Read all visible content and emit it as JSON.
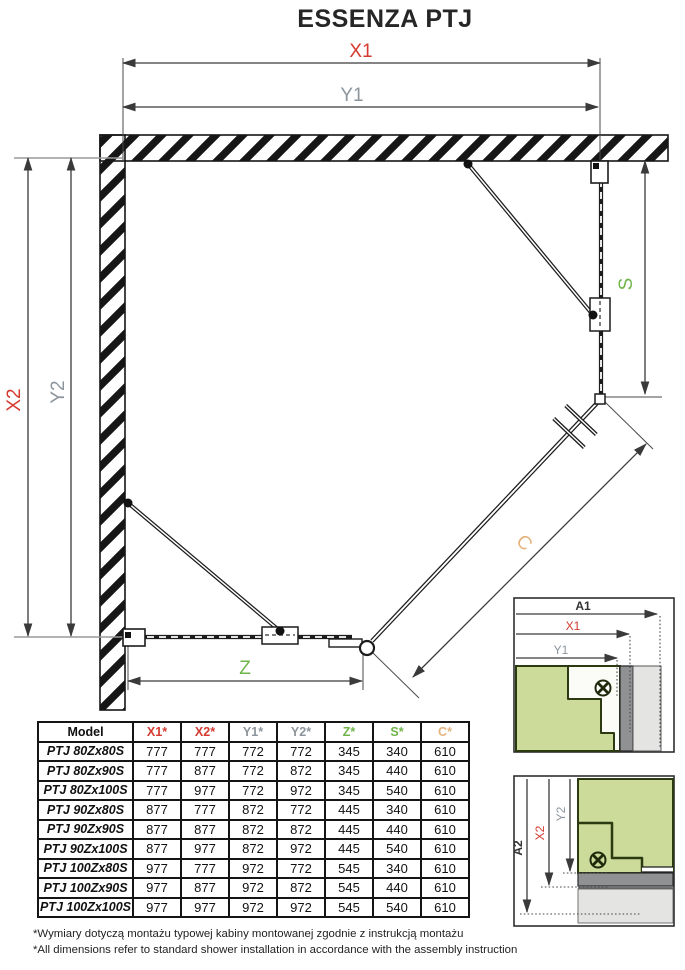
{
  "title": "ESSENZA PTJ",
  "colors": {
    "red": "#d43a2f",
    "gray": "#8d959c",
    "green": "#6fb44a",
    "tan": "#e5b47d"
  },
  "drawing": {
    "dim_labels": {
      "x1": "X1",
      "y1": "Y1",
      "x2": "X2",
      "y2": "Y2",
      "z": "Z",
      "s": "S",
      "c": "C"
    }
  },
  "detail_a1": {
    "dims": {
      "a1": "A1",
      "x1": "X1",
      "y1": "Y1"
    }
  },
  "detail_a2": {
    "dims": {
      "a2": "A2",
      "x2": "X2",
      "y2": "Y2"
    }
  },
  "table": {
    "headers": [
      {
        "label": "Model",
        "color_key": "dark"
      },
      {
        "label": "X1*",
        "color_key": "red"
      },
      {
        "label": "X2*",
        "color_key": "red"
      },
      {
        "label": "Y1*",
        "color_key": "gray"
      },
      {
        "label": "Y2*",
        "color_key": "gray"
      },
      {
        "label": "Z*",
        "color_key": "green"
      },
      {
        "label": "S*",
        "color_key": "green"
      },
      {
        "label": "C*",
        "color_key": "tan"
      }
    ],
    "rows": [
      {
        "model": "PTJ 80Zx80S",
        "values": [
          "777",
          "777",
          "772",
          "772",
          "345",
          "340",
          "610"
        ]
      },
      {
        "model": "PTJ 80Zx90S",
        "values": [
          "777",
          "877",
          "772",
          "872",
          "345",
          "440",
          "610"
        ]
      },
      {
        "model": "PTJ 80Zx100S",
        "values": [
          "777",
          "977",
          "772",
          "972",
          "345",
          "540",
          "610"
        ]
      },
      {
        "model": "PTJ 90Zx80S",
        "values": [
          "877",
          "777",
          "872",
          "772",
          "445",
          "340",
          "610"
        ]
      },
      {
        "model": "PTJ 90Zx90S",
        "values": [
          "877",
          "877",
          "872",
          "872",
          "445",
          "440",
          "610"
        ]
      },
      {
        "model": "PTJ 90Zx100S",
        "values": [
          "877",
          "977",
          "872",
          "972",
          "445",
          "540",
          "610"
        ]
      },
      {
        "model": "PTJ 100Zx80S",
        "values": [
          "977",
          "777",
          "972",
          "772",
          "545",
          "340",
          "610"
        ]
      },
      {
        "model": "PTJ 100Zx90S",
        "values": [
          "977",
          "877",
          "972",
          "872",
          "545",
          "440",
          "610"
        ]
      },
      {
        "model": "PTJ 100Zx100S",
        "values": [
          "977",
          "977",
          "972",
          "972",
          "545",
          "540",
          "610"
        ]
      }
    ]
  },
  "footnotes": [
    "*Wymiary dotyczą montażu typowej kabiny montowanej zgodnie z instrukcją montażu",
    "*All dimensions refer to standard shower installation in accordance with the assembly instruction"
  ]
}
